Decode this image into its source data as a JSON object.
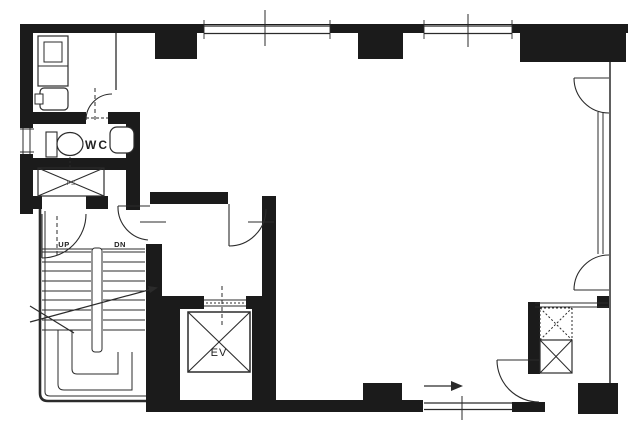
{
  "title": "Building floor plan",
  "labels": {
    "wc": "WC",
    "ev": "EV",
    "up": "UP",
    "dn": "DN",
    "ps": "PS"
  },
  "colors": {
    "wall": "#1b1b1b",
    "line": "#2b2b2b",
    "background": "#ffffff"
  }
}
